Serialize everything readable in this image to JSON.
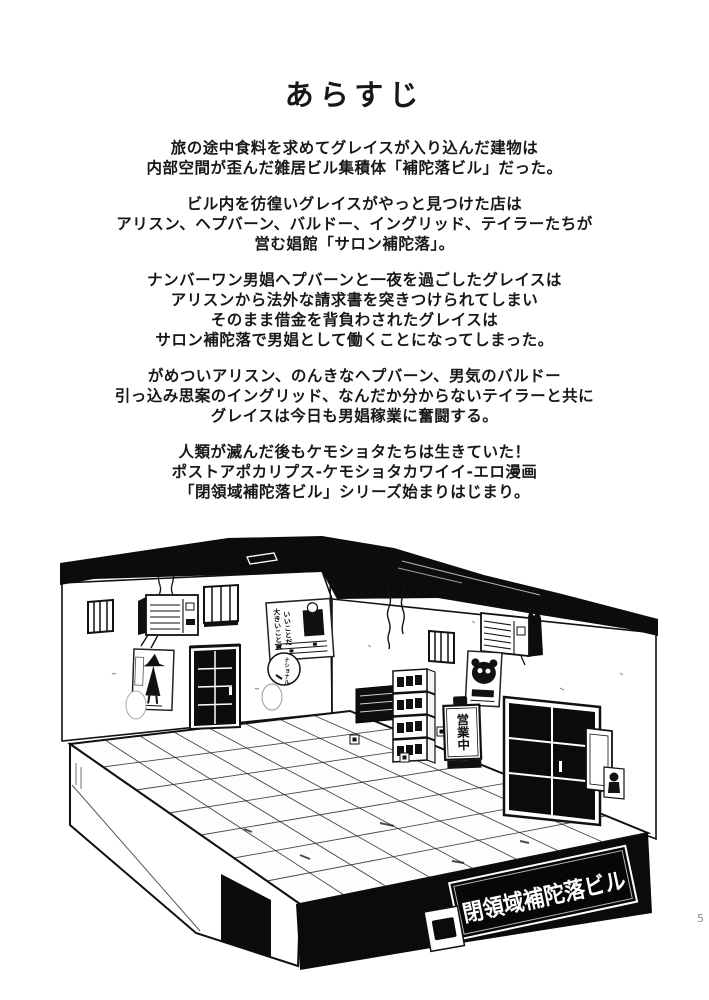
{
  "page": {
    "title": "あらすじ",
    "page_number": "5",
    "paragraphs": [
      {
        "lines": [
          "旅の途中食料を求めてグレイスが入り込んだ建物は",
          "内部空間が歪んだ雑居ビル集積体「補陀落ビル」だった。"
        ]
      },
      {
        "lines": [
          "ビル内を彷徨いグレイスがやっと見つけた店は",
          "アリスン、ヘプバーン、バルドー、イングリッド、テイラーたちが",
          "営む娼館「サロン補陀落」。"
        ]
      },
      {
        "lines": [
          "ナンバーワン男娼ヘプバーンと一夜を過ごしたグレイスは",
          "アリスンから法外な請求書を突きつけられてしまい",
          "そのまま借金を背負わされたグレイスは",
          "サロン補陀落で男娼として働くことになってしまった。"
        ]
      },
      {
        "lines": [
          "がめついアリスン、のんきなヘプバーン、男気のバルドー",
          "引っ込み思案のイングリッド、なんだか分からないテイラーと共に",
          "グレイスは今日も男娼稼業に奮闘する。"
        ]
      },
      {
        "lines": [
          "人類が滅んだ後もケモショタたちは生きていた！",
          "ポストアポカリプス-ケモショタカワイイ-エロ漫画",
          "「閉領域補陀落ビル」シリーズ始まりはじまり。"
        ]
      }
    ]
  },
  "illustration": {
    "building_sign_label": "閉領域補陀落ビル",
    "standing_sign_label": "営業中",
    "ad_poster_lines": [
      "大きいことは",
      "いいことだ"
    ],
    "sticker_label": "ナショナル",
    "colors": {
      "ink": "#0c0c0c",
      "paper": "#ffffff"
    }
  }
}
